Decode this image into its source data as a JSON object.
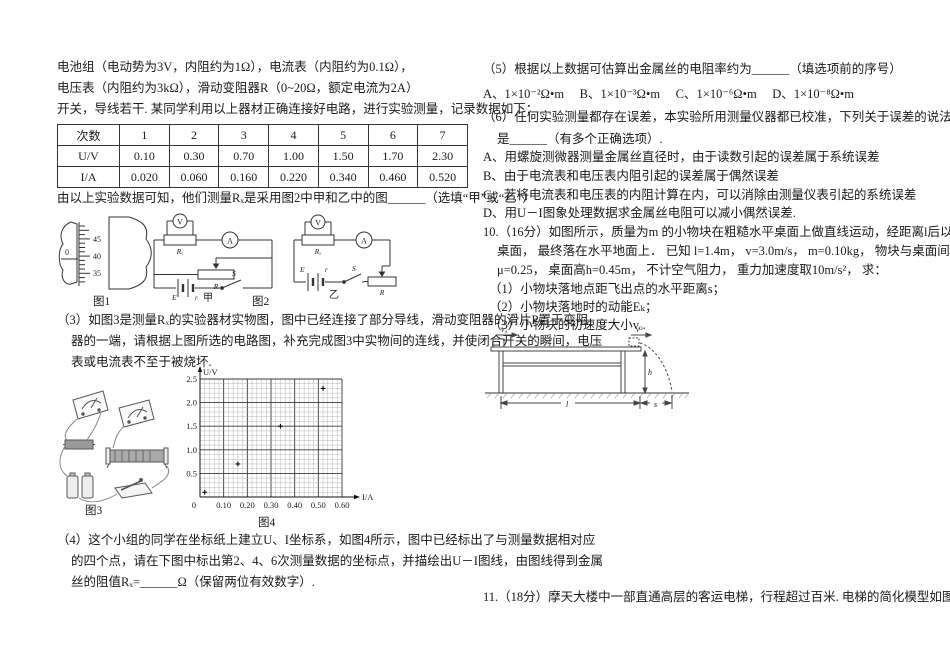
{
  "left": {
    "intro_lines": [
      "电池组（电动势为3V，内阻约为1Ω），电流表（内阻约为0.1Ω），",
      "电压表（内阻约为3kΩ），滑动变阻器R（0~20Ω，额定电流为2A）",
      "开关，导线若干. 某同学利用以上器材正确连接好电路，进行实验测量，记录数据如下："
    ],
    "data_table": {
      "header": [
        "次数",
        "1",
        "2",
        "3",
        "4",
        "5",
        "6",
        "7"
      ],
      "rows": [
        [
          "U/V",
          "0.10",
          "0.30",
          "0.70",
          "1.00",
          "1.50",
          "1.70",
          "2.30"
        ],
        [
          "I/A",
          "0.020",
          "0.060",
          "0.160",
          "0.220",
          "0.340",
          "0.460",
          "0.520"
        ]
      ]
    },
    "after_table": "由以上实验数据可知，他们测量Rₓ是采用图2中甲和乙中的图______（选填“甲”或“乙”）",
    "q3_lines": [
      "（3）如图3是测量Rₓ的实验器材实物图，图中已经连接了部分导线，滑动变阻器的滑片P置于变阻",
      "器的一端，请根据上图所选的电路图，补充完成图3中实物间的连线，并使闭合开关的瞬间，电压",
      "表或电流表不至于被烧坏."
    ],
    "q4_lines": [
      "（4）这个小组的同学在坐标纸上建立U、I坐标系，如图4所示，图中已经标出了与测量数据相对应",
      "的四个点，请在下图中标出第2、4、6次测量数据的坐标点，并描绘出U－I图线，由图线得到金属",
      "丝的阻值Rₓ=______Ω（保留两位有效数字）."
    ]
  },
  "right": {
    "q5_line": "（5）根据以上数据可估算出金属丝的电阻率约为______（填选项前的序号）",
    "q5_options": "A、1×10⁻²Ω•m　 B、1×10⁻³Ω•m　 C、1×10⁻⁶Ω•m　 D、1×10⁻⁸Ω•m",
    "q6_lines": [
      "（6）任何实验测量都存在误差，本实验所用测量仪器都已校准，下列关于误差的说法中正确的选项",
      "是______（有多个正确选项）."
    ],
    "q6_options": [
      "A、用螺旋测微器测量金属丝直径时，由于读数引起的误差属于系统误差",
      "B、由于电流表和电压表内阻引起的误差属于偶然误差",
      "C、若将电流表和电压表的内阻计算在内，可以消除由测量仪表引起的系统误差",
      "D、用U－I图象处理数据求金属丝电阻可以减小偶然误差."
    ],
    "q10_lines": [
      "10.（16分）如图所示，质量为m 的小物块在粗糙水平桌面上做直线运动，经距离l后以速度v 飞离",
      "桌面， 最终落在水平地面上． 已知 l=1.4m， v=3.0m/s， m=0.10kg， 物块与桌面间的动摩擦因数",
      "μ=0.25， 桌面高h=0.45m， 不计空气阻力， 重力加速度取10m/s²， 求："
    ],
    "q10_subs": [
      "（1）小物块落地点距飞出点的水平距离s；",
      "（2）小物块落地时的动能Eₖ；",
      "（3）小物块的初速度大小vₒ."
    ],
    "q11_line": "11.（18分）摩天大楼中一部直通高层的客运电梯，行程超过百米. 电梯的简化模型如图1所示. 考虑"
  },
  "figures": {
    "fig1": {
      "caption": "图1",
      "thimble_ticks": [
        "45",
        "40",
        "35"
      ],
      "sleeve_zero": "0"
    },
    "fig2": {
      "caption": "图2",
      "jia_label": "甲",
      "yi_label": "乙",
      "voltmeter": "V",
      "ammeter": "A",
      "rx": "Rₓ",
      "rheostat": "R",
      "switch": "S",
      "emf": "E",
      "internal_r": "r"
    },
    "fig3": {
      "caption": "图3"
    },
    "fig10": {
      "v0": "v₀",
      "v": "v",
      "h": "h",
      "l": "l",
      "s": "s"
    }
  },
  "chart_data": {
    "type": "scatter",
    "caption": "图4",
    "xlabel": "I/A",
    "ylabel": "U/V",
    "xlim": [
      0,
      0.6
    ],
    "ylim": [
      0,
      2.5
    ],
    "x_minor": 0.02,
    "x_major": 0.1,
    "y_minor": 0.1,
    "y_major": 0.5,
    "grid": true,
    "origin_label": "0",
    "x_ticks": [
      "0.10",
      "0.20",
      "0.30",
      "0.40",
      "0.50",
      "0.60"
    ],
    "y_ticks": [
      "0.5",
      "1.0",
      "1.5",
      "2.0",
      "2.5"
    ],
    "points": [
      {
        "x": 0.02,
        "y": 0.1
      },
      {
        "x": 0.16,
        "y": 0.7
      },
      {
        "x": 0.34,
        "y": 1.5
      },
      {
        "x": 0.52,
        "y": 2.3
      }
    ]
  }
}
